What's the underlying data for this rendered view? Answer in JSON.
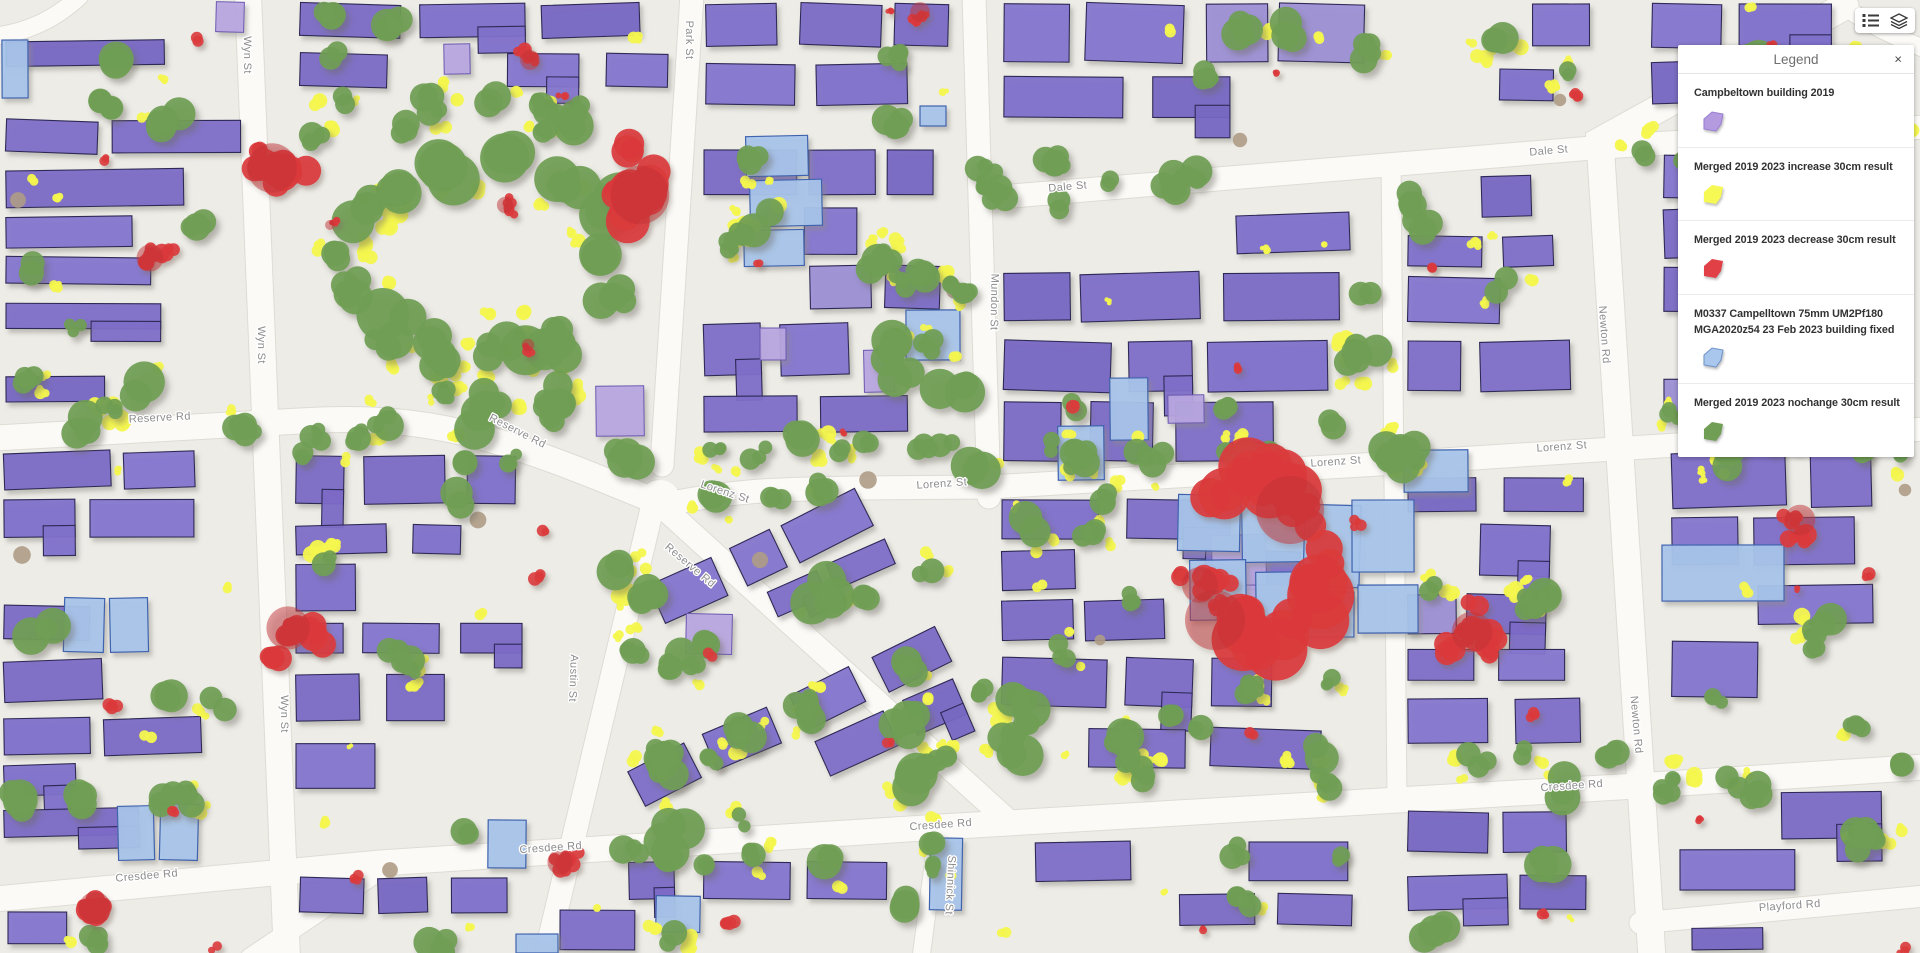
{
  "legend": {
    "title": "Legend",
    "close_icon": "×",
    "items": [
      {
        "label": "Campbeltown building 2019",
        "swatch_fill": "#b49be0",
        "swatch_stroke": "#9a7fd1"
      },
      {
        "label": "Merged 2019 2023 increase 30cm result",
        "swatch_fill": "#f6f854",
        "swatch_stroke": "none"
      },
      {
        "label": "Merged 2019 2023 decrease 30cm result",
        "swatch_fill": "#e04046",
        "swatch_stroke": "none"
      },
      {
        "label": "M0337 Campelltown 75mm UM2Pf180 MGA2020z54 23 Feb 2023 building fixed",
        "swatch_fill": "#a9c6ec",
        "swatch_stroke": "#6e93c8"
      },
      {
        "label": "Merged 2019 2023 nochange 30cm result",
        "swatch_fill": "#6f9e54",
        "swatch_stroke": "none"
      }
    ]
  },
  "toolbar": {
    "buttons": [
      {
        "name": "legend-toggle",
        "icon": "legend-list-icon"
      },
      {
        "name": "layers-toggle",
        "icon": "layers-icon"
      }
    ]
  },
  "map": {
    "colors": {
      "background": "#edece7",
      "road": "#fbfaf7",
      "road_casing": "#dedcd3",
      "building_2023": "#7b6cc6",
      "building_2023_stroke": "#2e2957",
      "building_2019_only": "#b7a6e1",
      "building_2019_stroke": "#6c59b0",
      "building_fixed": "#a7c4ea",
      "building_fixed_stroke": "#3f63ae",
      "nochange_green": "#6f9e54",
      "increase_yellow": "#f4f74e",
      "decrease_red": "#da3a3c",
      "decrease_red_dark": "#c23338",
      "bare_tan": "#ae9c85",
      "street_label": "#8c8c8c"
    },
    "street_labels": [
      {
        "text": "Wyn St",
        "x": 244,
        "y": 55,
        "rot": 90
      },
      {
        "text": "Wyn St",
        "x": 258,
        "y": 345,
        "rot": 90
      },
      {
        "text": "Wyn St",
        "x": 281,
        "y": 714,
        "rot": 90
      },
      {
        "text": "Park St",
        "x": 686,
        "y": 40,
        "rot": 90
      },
      {
        "text": "Mundon St",
        "x": 991,
        "y": 302,
        "rot": 91
      },
      {
        "text": "Dale St",
        "x": 1068,
        "y": 190,
        "rot": -5
      },
      {
        "text": "Dale St",
        "x": 1549,
        "y": 154,
        "rot": -5
      },
      {
        "text": "Newton Rd",
        "x": 1601,
        "y": 335,
        "rot": 86
      },
      {
        "text": "Newton Rd",
        "x": 1633,
        "y": 725,
        "rot": 85
      },
      {
        "text": "Reserve Rd",
        "x": 160,
        "y": 421,
        "rot": -3
      },
      {
        "text": "Reserve Rd",
        "x": 516,
        "y": 434,
        "rot": 27
      },
      {
        "text": "Reserve Rd",
        "x": 688,
        "y": 568,
        "rot": 40
      },
      {
        "text": "Lorenz St",
        "x": 724,
        "y": 495,
        "rot": 18
      },
      {
        "text": "Lorenz St",
        "x": 942,
        "y": 487,
        "rot": -4
      },
      {
        "text": "Lorenz St",
        "x": 1336,
        "y": 465,
        "rot": -4
      },
      {
        "text": "Lorenz St",
        "x": 1562,
        "y": 450,
        "rot": -4
      },
      {
        "text": "Austin St",
        "x": 570,
        "y": 678,
        "rot": 92
      },
      {
        "text": "Shinnick St",
        "x": 947,
        "y": 885,
        "rot": 93
      },
      {
        "text": "Cresdee Rd",
        "x": 147,
        "y": 879,
        "rot": -5
      },
      {
        "text": "Cresdee Rd",
        "x": 551,
        "y": 851,
        "rot": -4
      },
      {
        "text": "Cresdee Rd",
        "x": 941,
        "y": 828,
        "rot": -4
      },
      {
        "text": "Cresdee Rd",
        "x": 1572,
        "y": 789,
        "rot": -4
      },
      {
        "text": "Playford Rd",
        "x": 1790,
        "y": 909,
        "rot": -4
      }
    ]
  }
}
